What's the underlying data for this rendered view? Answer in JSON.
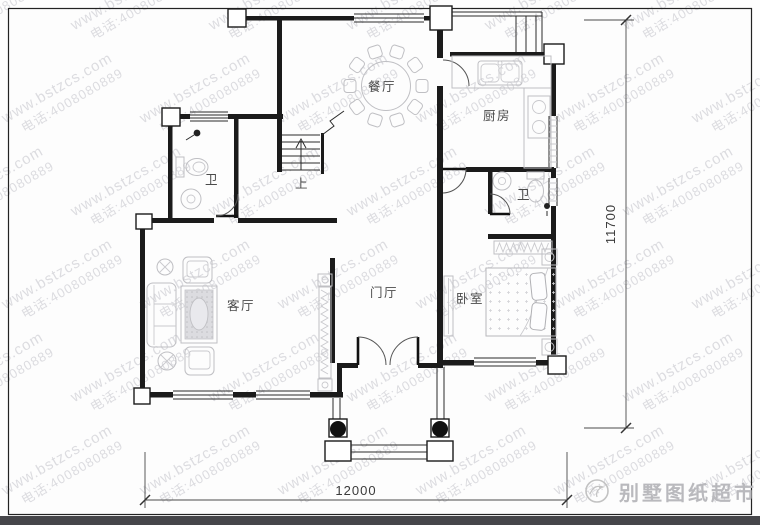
{
  "watermark": {
    "line1": "www.bstzcs.com",
    "line2": "电话:4008080889"
  },
  "plan": {
    "rooms": {
      "dining": {
        "label": "餐厅"
      },
      "kitchen": {
        "label": "厨房"
      },
      "bath_upper": {
        "label": "卫"
      },
      "bath_lower": {
        "label": "卫"
      },
      "living": {
        "label": "客厅"
      },
      "foyer": {
        "label": "门厅"
      },
      "bedroom": {
        "label": "卧室"
      }
    },
    "stairs": {
      "up_label": "上"
    },
    "dimensions": {
      "bottom": "12000",
      "right": "11700"
    }
  },
  "branding": {
    "site_name": "别墅图纸超市"
  },
  "colors": {
    "wall": "#1b1b1b",
    "furniture": "#bfbfc3",
    "watermark": "#dcdce0",
    "dimension_text": "#3a3a3a",
    "logo_text": "#b9b9bd",
    "bottom_bar": "#46464a"
  }
}
